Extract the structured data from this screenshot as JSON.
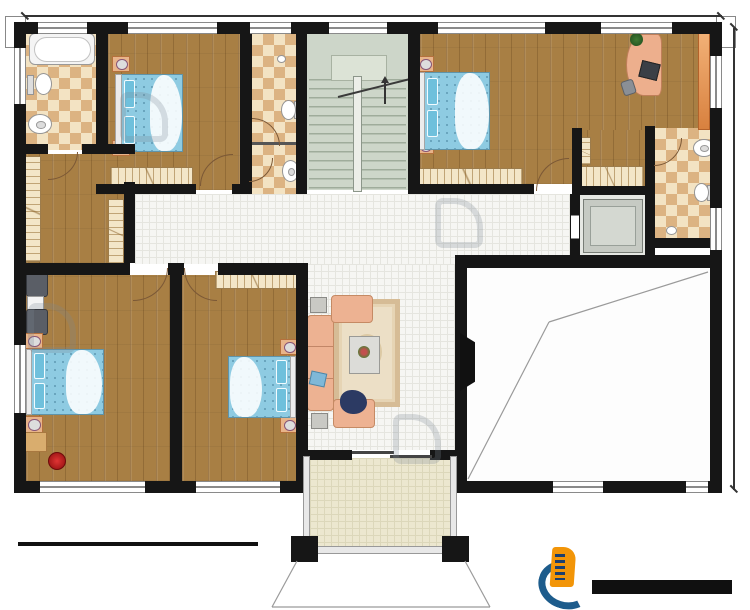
{
  "dims": {
    "top": "20600",
    "right": "15500"
  },
  "rooms": {
    "bath_tl": {
      "name": "内卫",
      "area": "7.93m²"
    },
    "bed_tl": {
      "name": "卧室",
      "area": "16.23m²"
    },
    "pub_bath": {
      "name": "公卫",
      "area": "6.32m²"
    },
    "wash": {
      "name": "洗漱间",
      "area": "2.48m²"
    },
    "stair": {
      "name": "楼梯间",
      "area": "14.21m²"
    },
    "hall": {
      "name": "过道",
      "area": "25.60m²"
    },
    "bed_tr": {
      "name": "卧室",
      "area": "22.46m²"
    },
    "study": {
      "name": "书房",
      "area": "12.43m²"
    },
    "cloak_r": {
      "name": "衣帽间",
      "area": "3.23m²"
    },
    "bath_r": {
      "name": "内卫",
      "area": "6.11m²"
    },
    "lift": {
      "name": "电梯",
      "area": "4.04m²"
    },
    "cloak_l": {
      "name": "衣帽间",
      "area": "9.31m²"
    },
    "bed_bl": {
      "name": "卧室",
      "area": "27.29m²"
    },
    "bed_bm": {
      "name": "卧室",
      "area": "22.29m²"
    },
    "living": {
      "name": "起居室",
      "area": "25.30m²"
    },
    "void": {
      "name": "客厅挑空",
      "area": "46.83m²"
    },
    "balcony": {
      "name": "阳台",
      "area": "6.76m²"
    }
  },
  "stair_marks": {
    "down": "下",
    "up": "上"
  },
  "title_block": {
    "title": "二层平面图",
    "scale": "1:100",
    "area_line": "本层建筑面积: 288.74m²",
    "height_line": "层高: 3.60m"
  },
  "brand": {
    "name": "柏竣建筑",
    "site": "www.baijunjz.com"
  },
  "watermark": {
    "name": "柏竣建筑",
    "site": "www.baijunjz.com"
  },
  "colors": {
    "wall": "#161616",
    "wood": "#a87f44",
    "accent_orange": "#f29508",
    "accent_blue": "#1d5c8c"
  }
}
